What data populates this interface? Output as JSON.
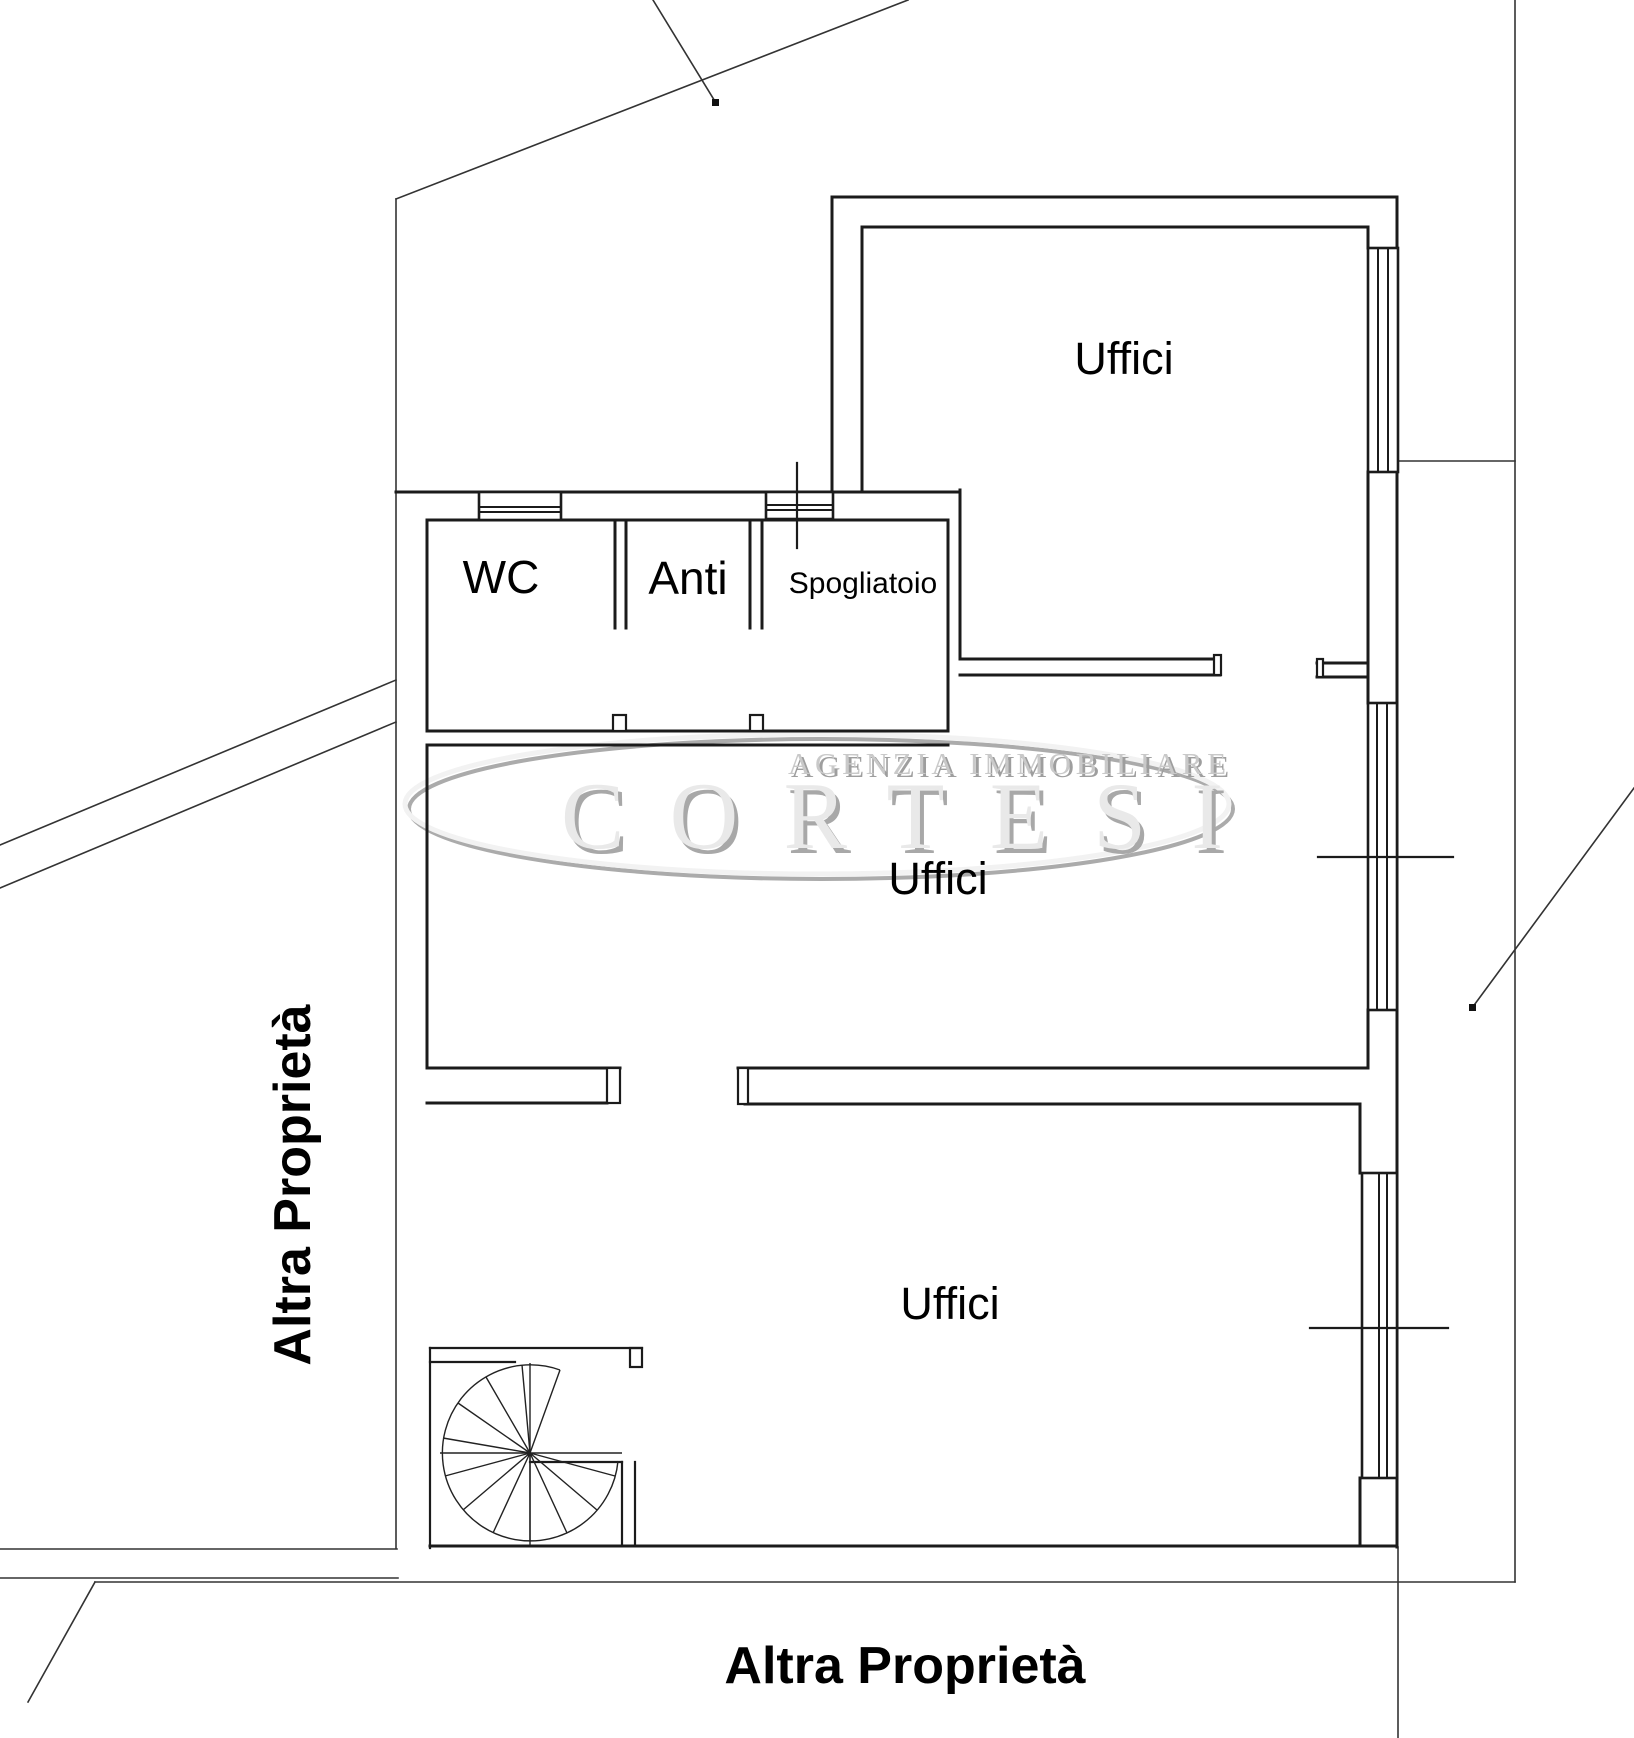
{
  "page": {
    "background_color": "#ffffff",
    "line_color": "#1b1b1b",
    "boundary_line_color": "#333333"
  },
  "plan": {
    "rooms": {
      "uffici_top": {
        "label": "Uffici"
      },
      "uffici_middle": {
        "label": "Uffici"
      },
      "uffici_bottom": {
        "label": "Uffici"
      },
      "wc": {
        "label": "WC"
      },
      "anti": {
        "label": "Anti"
      },
      "spogliatoio": {
        "label": "Spogliatoio"
      }
    },
    "outside": {
      "left_label": "Altra Proprietà",
      "bottom_label": "Altra Proprietà"
    },
    "features": {
      "spiral_stair": "spiral-staircase",
      "windows": "window-symbol",
      "section_ticks": "section-mark"
    }
  },
  "watermark": {
    "line1": "AGENZIA IMMOBILIARE",
    "line2": "CORTESI",
    "text_color": "#a9a9a9",
    "highlight_color": "#f2f2f2"
  }
}
